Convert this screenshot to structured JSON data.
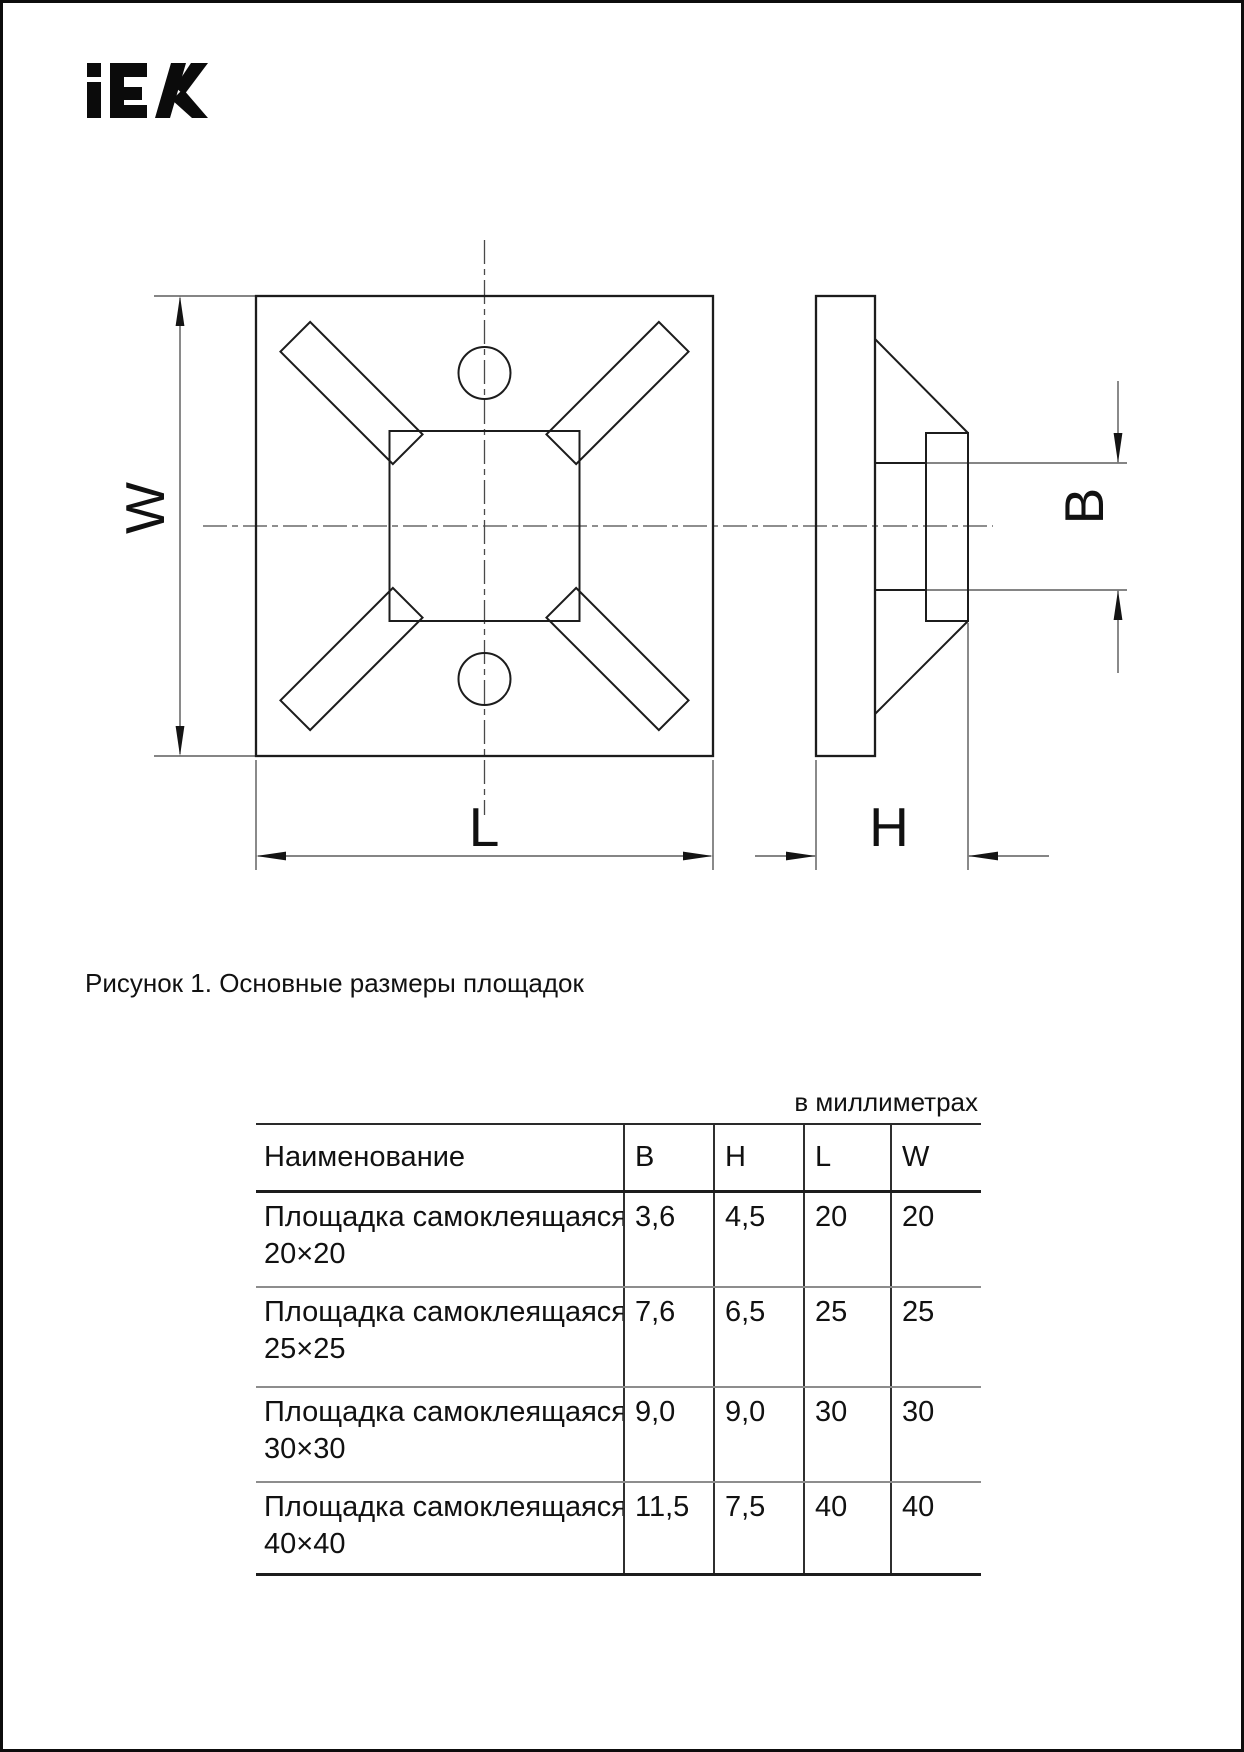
{
  "page": {
    "brand": "iEK",
    "caption": "Рисунок 1. Основные размеры площадок",
    "units_note": "в миллиметрах"
  },
  "figure": {
    "dim_labels": {
      "w": "W",
      "l": "L",
      "h": "H",
      "b": "B"
    }
  },
  "table": {
    "columns": {
      "name": "Наименование",
      "b": "B",
      "h": "H",
      "l": "L",
      "w": "W"
    },
    "rows": [
      {
        "name1": "Площадка самоклеящаяся",
        "name2": "20×20",
        "b": "3,6",
        "h": "4,5",
        "l": "20",
        "w": "20"
      },
      {
        "name1": "Площадка самоклеящаяся",
        "name2": "25×25",
        "b": "7,6",
        "h": "6,5",
        "l": "25",
        "w": "25"
      },
      {
        "name1": "Площадка самоклеящаяся",
        "name2": "30×30",
        "b": "9,0",
        "h": "9,0",
        "l": "30",
        "w": "30"
      },
      {
        "name1": "Площадка самоклеящаяся",
        "name2": "40×40",
        "b": "11,5",
        "h": "7,5",
        "l": "40",
        "w": "40"
      }
    ]
  }
}
